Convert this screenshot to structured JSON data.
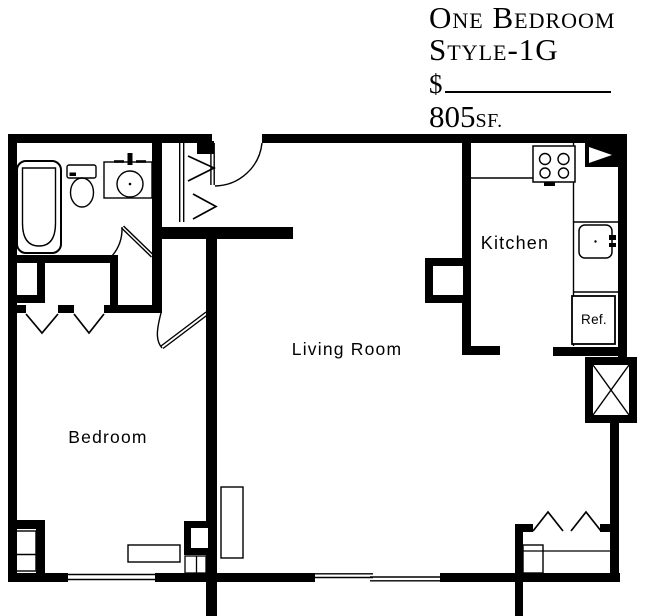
{
  "page": {
    "background": "#ffffff",
    "ink": "#000000"
  },
  "title_block": {
    "line1": "One Bedroom",
    "line2": "Style-1G",
    "price_symbol": "$",
    "price_value": "",
    "area_value": "805",
    "area_unit": "SF."
  },
  "room_labels": {
    "kitchen": "Kitchen",
    "living_room": "Living Room",
    "bedroom": "Bedroom",
    "refrigerator": "Ref."
  },
  "icons": {
    "bathtub": "tub outline (rounded rect)",
    "toilet": "tank + oval bowl",
    "bathroom_sink": "counter with round basin and faucet",
    "stove": "4 burner circles",
    "kitchen_sink": "rounded square basin",
    "shaft": "square with X",
    "closet_doors": "chevron bi-fold symbols",
    "doors": "arc swing symbols",
    "windows": "thin double lines in wall"
  }
}
